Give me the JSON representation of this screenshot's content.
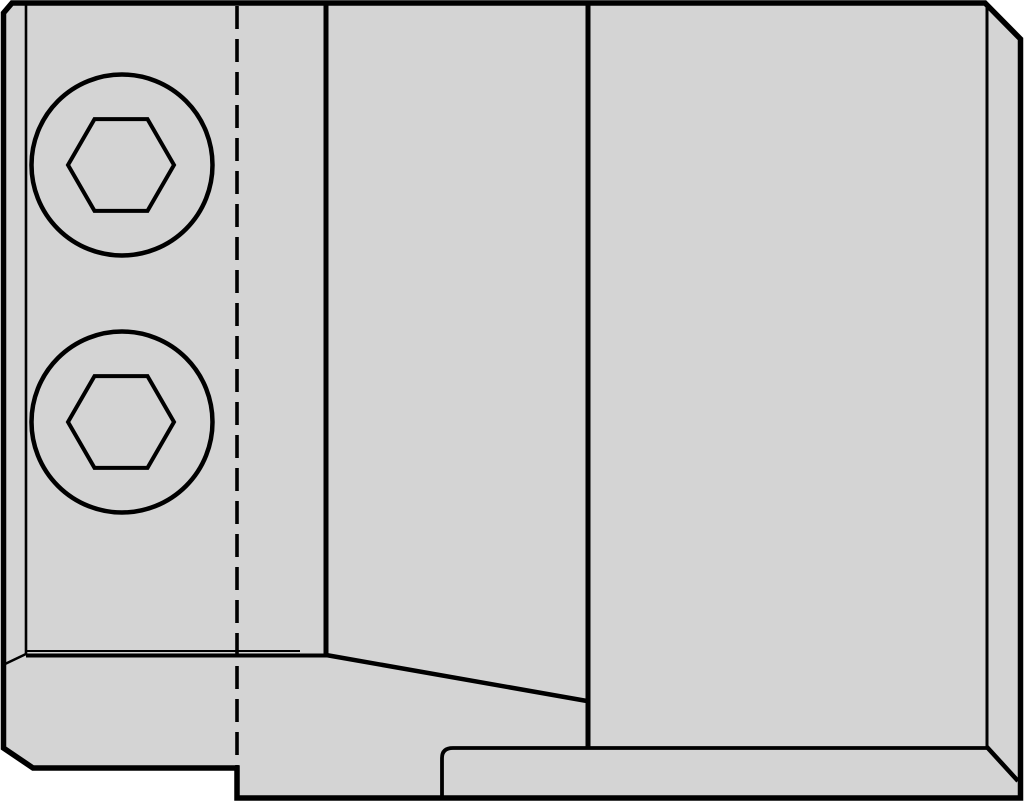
{
  "diagram": {
    "title": "technical-part-drawing",
    "canvas": {
      "width": 1024,
      "height": 806,
      "background": "#ffffff"
    },
    "colors": {
      "part_fill": "#d4d4d4",
      "line": "#000000",
      "background": "#ffffff"
    },
    "elements": [
      {
        "name": "part-body-outline",
        "kind": "polygon",
        "attrs": {
          "points": "12,3 985,3 1020.5,39 1020.5,798 237,798 237,768 33,768 3.5,748 3.5,13",
          "fill": "#d4d4d4",
          "stroke": "#000000",
          "stroke-width": "5.5",
          "stroke-linejoin": "miter"
        }
      },
      {
        "name": "hidden-center-line",
        "kind": "line",
        "attrs": {
          "x1": "237",
          "y1": "6",
          "x2": "237",
          "y2": "766",
          "stroke": "#000000",
          "stroke-width": "3.6",
          "stroke-dasharray": "23 10"
        }
      },
      {
        "name": "left-flange-edge-line",
        "kind": "line",
        "attrs": {
          "x1": "26",
          "y1": "2",
          "x2": "26",
          "y2": "655",
          "stroke": "#000000",
          "stroke-width": "2.6"
        }
      },
      {
        "name": "left-flange-corner-edge",
        "kind": "line",
        "attrs": {
          "x1": "26",
          "y1": "654",
          "x2": "5",
          "y2": "664",
          "stroke": "#000000",
          "stroke-width": "2.4"
        }
      },
      {
        "name": "front-face-bottom-edge",
        "kind": "line",
        "attrs": {
          "x1": "26",
          "y1": "651",
          "x2": "300",
          "y2": "651",
          "stroke": "#000000",
          "stroke-width": "2"
        }
      },
      {
        "name": "shoulder-top-edge",
        "kind": "line",
        "attrs": {
          "x1": "26",
          "y1": "655.5",
          "x2": "328",
          "y2": "655.5",
          "stroke": "#000000",
          "stroke-width": "4"
        }
      },
      {
        "name": "body-segment-edge-left",
        "kind": "line",
        "attrs": {
          "x1": "326",
          "y1": "2",
          "x2": "326",
          "y2": "656",
          "stroke": "#000000",
          "stroke-width": "5"
        }
      },
      {
        "name": "sloped-shoulder-edge",
        "kind": "line",
        "attrs": {
          "x1": "326",
          "y1": "655",
          "x2": "587",
          "y2": "701",
          "stroke": "#000000",
          "stroke-width": "4.5"
        }
      },
      {
        "name": "body-segment-edge-right",
        "kind": "line",
        "attrs": {
          "x1": "588",
          "y1": "2",
          "x2": "588",
          "y2": "747",
          "stroke": "#000000",
          "stroke-width": "5"
        }
      },
      {
        "name": "pocket-step-edge",
        "kind": "path",
        "attrs": {
          "d": "M 442,799 L 442,758 Q 442,748 453,748 L 987,748",
          "fill": "none",
          "stroke": "#000000",
          "stroke-width": "3.8"
        }
      },
      {
        "name": "right-side-face-edge",
        "kind": "line",
        "attrs": {
          "x1": "987",
          "y1": "5",
          "x2": "987",
          "y2": "747",
          "stroke": "#000000",
          "stroke-width": "3"
        }
      },
      {
        "name": "bottom-right-bevel-edge",
        "kind": "line",
        "attrs": {
          "x1": "986",
          "y1": "746",
          "x2": "1018",
          "y2": "781",
          "stroke": "#000000",
          "stroke-width": "4.5"
        }
      },
      {
        "name": "screw-top-head-circle",
        "kind": "circle",
        "attrs": {
          "cx": "122",
          "cy": "165",
          "r": "90.5",
          "fill": "none",
          "stroke": "#000000",
          "stroke-width": "4.5"
        }
      },
      {
        "name": "screw-top-hex-socket",
        "kind": "polygon",
        "attrs": {
          "points": "174,165 147.5,119.1 94.5,119.1 68,165 94.5,210.9 147.5,210.9",
          "fill": "none",
          "stroke": "#000000",
          "stroke-width": "4",
          "stroke-linejoin": "miter"
        }
      },
      {
        "name": "screw-bottom-head-circle",
        "kind": "circle",
        "attrs": {
          "cx": "122",
          "cy": "422",
          "r": "90.5",
          "fill": "none",
          "stroke": "#000000",
          "stroke-width": "4.5"
        }
      },
      {
        "name": "screw-bottom-hex-socket",
        "kind": "polygon",
        "attrs": {
          "points": "174,422 147.5,376.1 94.5,376.1 68,422 94.5,467.9 147.5,467.9",
          "fill": "none",
          "stroke": "#000000",
          "stroke-width": "4",
          "stroke-linejoin": "miter"
        }
      }
    ]
  }
}
